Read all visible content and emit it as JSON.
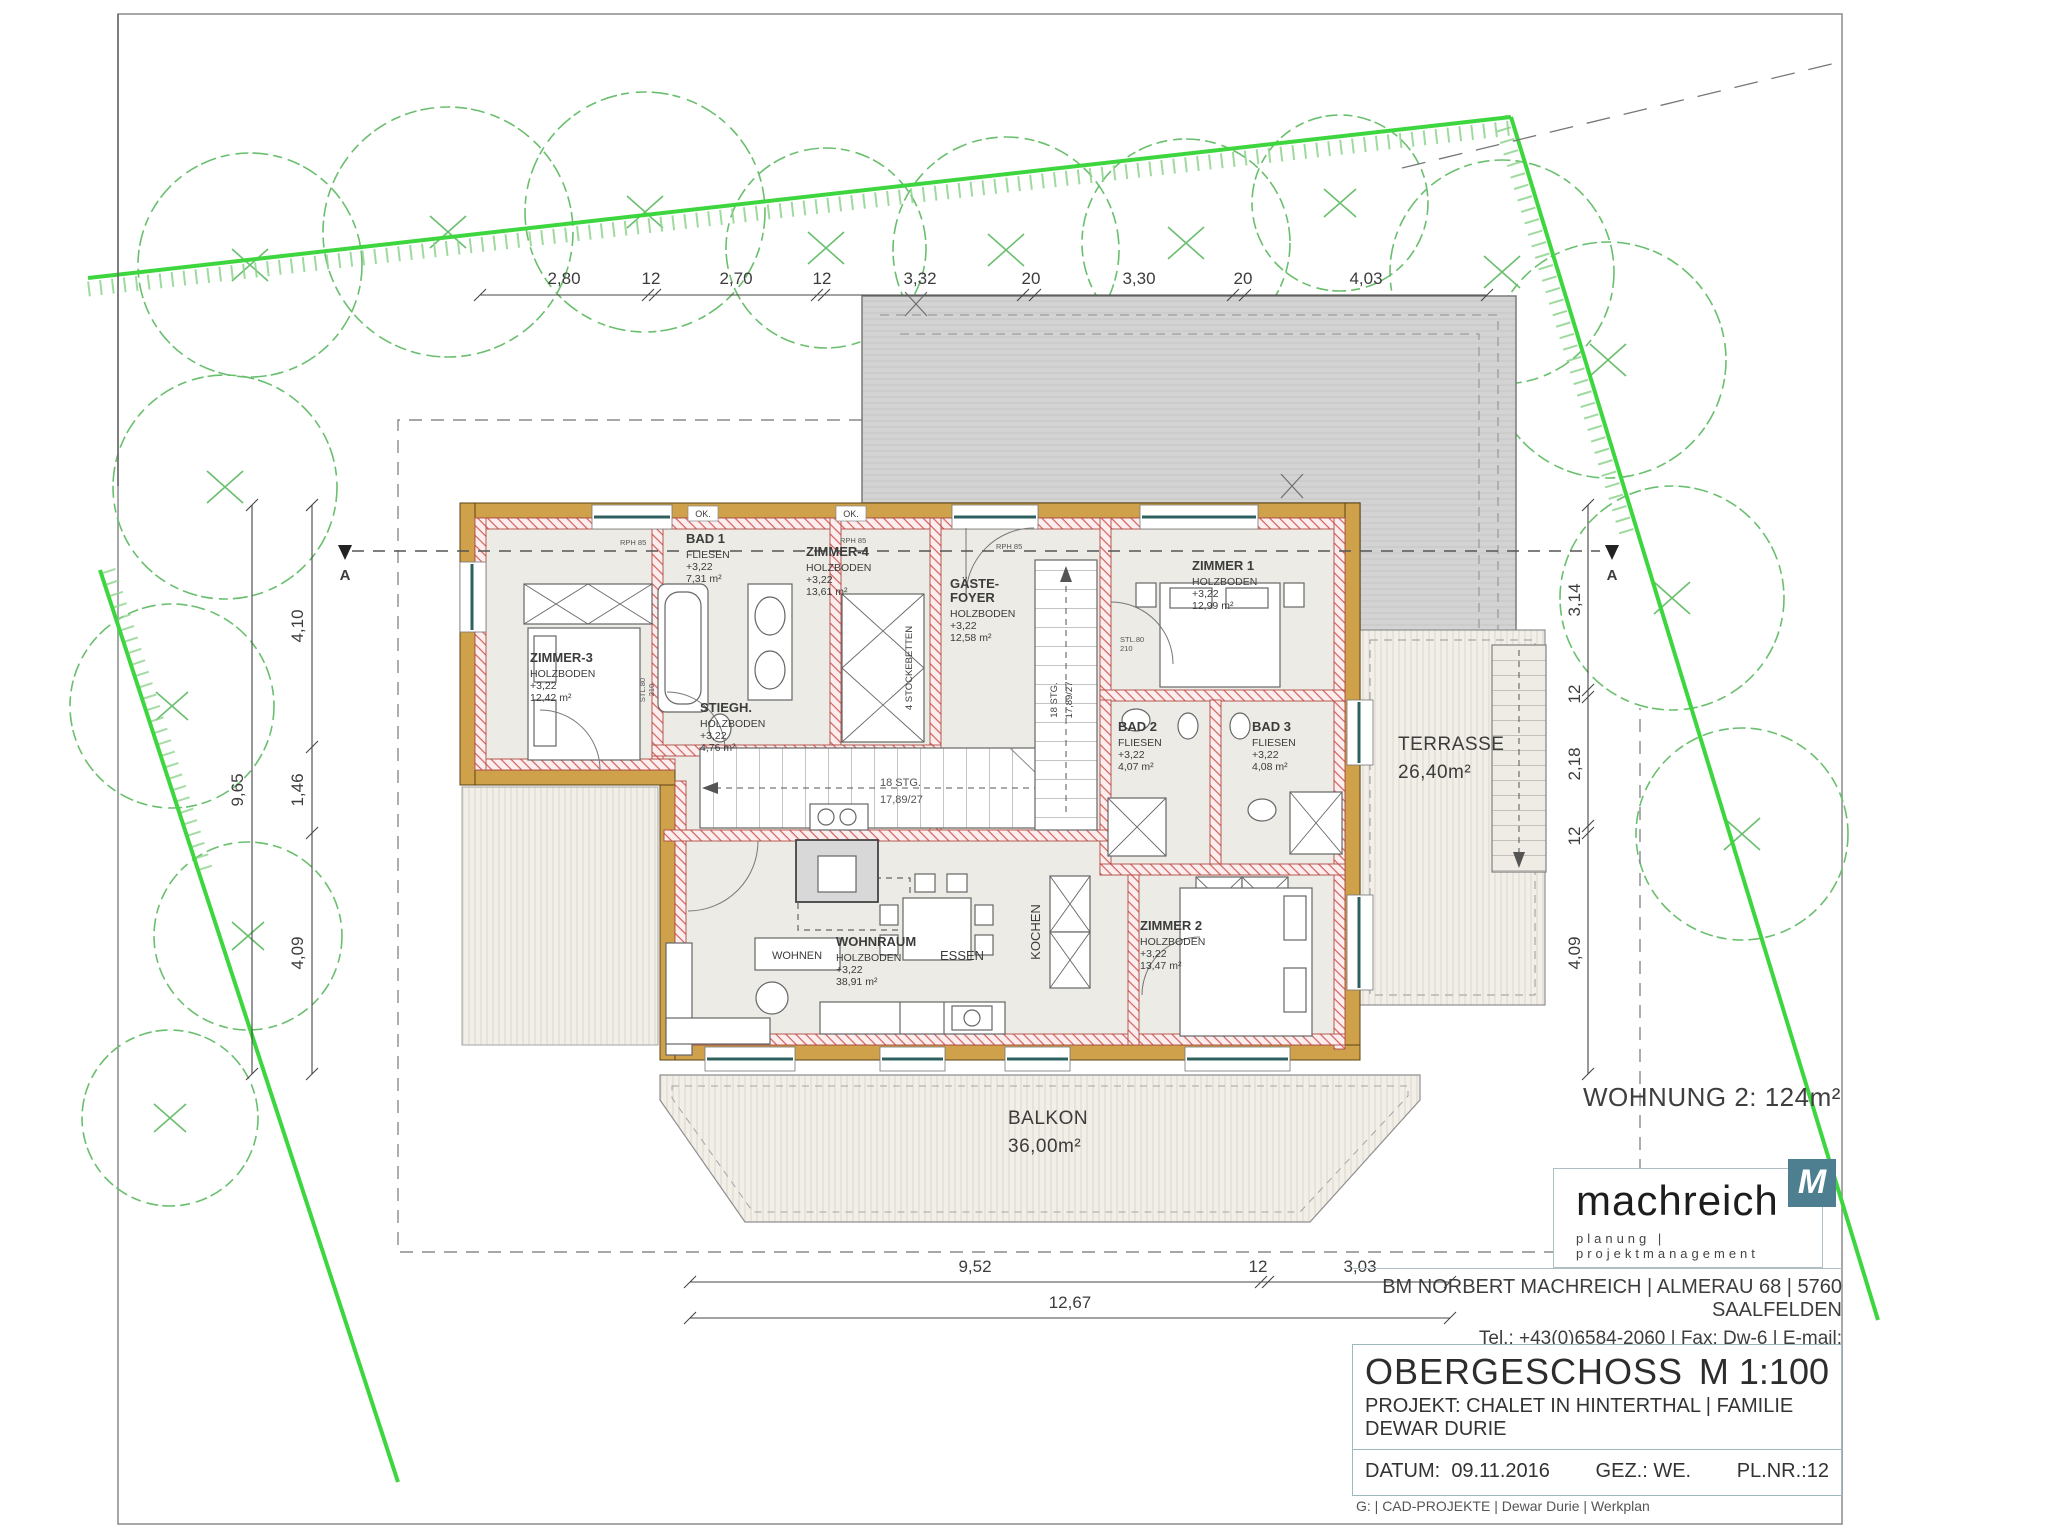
{
  "dims": {
    "top": [
      "2,80",
      "12",
      "2,70",
      "12",
      "3,32",
      "20",
      "3,30",
      "20",
      "4,03"
    ],
    "left": [
      "4,10",
      "1,46",
      "4,09"
    ],
    "left_total": "9,65",
    "right": [
      "3,14",
      "12",
      "2,18",
      "12",
      "4,09"
    ],
    "bottom": [
      "9,52",
      "12",
      "3,03"
    ],
    "bottom_total": "12,67"
  },
  "rooms": {
    "zimmer3": {
      "name": "ZIMMER-3",
      "floor": "HOLZBODEN",
      "level": "+3,22",
      "area": "12,42 m²"
    },
    "bad1": {
      "name": "BAD 1",
      "floor": "FLIESEN",
      "level": "+3,22",
      "area": "7,31 m²"
    },
    "zimmer4": {
      "name": "ZIMMER-4",
      "floor": "HOLZBODEN",
      "level": "+3,22",
      "area": "13,61 m²"
    },
    "stiegh": {
      "name": "STIEGH.",
      "floor": "HOLZBODEN",
      "level": "+3,22",
      "area": "4,76 m²"
    },
    "foyer": {
      "name1": "GÄSTE-",
      "name2": "FOYER",
      "floor": "HOLZBODEN",
      "level": "+3,22",
      "area": "12,58 m²"
    },
    "zimmer1": {
      "name": "ZIMMER 1",
      "floor": "HOLZBODEN",
      "level": "+3,22",
      "area": "12,99 m²"
    },
    "bad2": {
      "name": "BAD 2",
      "floor": "FLIESEN",
      "level": "+3,22",
      "area": "4,07 m²"
    },
    "bad3": {
      "name": "BAD 3",
      "floor": "FLIESEN",
      "level": "+3,22",
      "area": "4,08 m²"
    },
    "zimmer2": {
      "name": "ZIMMER 2",
      "floor": "HOLZBODEN",
      "level": "+3,22",
      "area": "13,47 m²"
    },
    "wohnraum": {
      "name": "WOHNRAUM",
      "floor": "HOLZBODEN",
      "level": "+3,22",
      "area": "38,91 m²"
    }
  },
  "zones": {
    "wohnen": "WOHNEN",
    "essen": "ESSEN",
    "kochen": "KOCHEN",
    "terrasse": "TERRASSE",
    "terrasse_area": "26,40m²",
    "balkon": "BALKON",
    "balkon_area": "36,00m²"
  },
  "stairs": {
    "count": "18 STG.",
    "rise_run": "17,89/27",
    "bunks": "4 STOCKEBETTEN"
  },
  "marks": {
    "section": "A",
    "ok": "OK.",
    "rph": "RPH 85",
    "door_type": "STL.80",
    "door_width": "210",
    "wohnung": "WOHNUNG 2:  124m²"
  },
  "company": {
    "name": "machreich",
    "tagline": "planung | projektmanagement",
    "logo_letter": "M",
    "logo_color": "#4d7f90",
    "address": "BM NORBERT MACHREICH | ALMERAU 68 | 5760 SAALFELDEN",
    "contact": "Tel.: +43(0)6584-2060 | Fax: Dw-6 | E-mail: office@machreich.at"
  },
  "titleblock": {
    "title": "OBERGESCHOSS",
    "scale": "M 1:100",
    "project": "PROJEKT: CHALET IN HINTERTHAL | FAMILIE DEWAR DURIE",
    "datum_label": "DATUM:",
    "datum": "09.11.2016",
    "gez": "GEZ.: WE.",
    "plnr": "PL.NR.:12",
    "footer": "G: | CAD-PROJEKTE | Dewar Durie | Werkplan"
  },
  "colors": {
    "boundary": "#3ed63e",
    "trees": "#6abf6e",
    "wood_wall": "#cfa14b",
    "roof": "#d2d2d2"
  }
}
